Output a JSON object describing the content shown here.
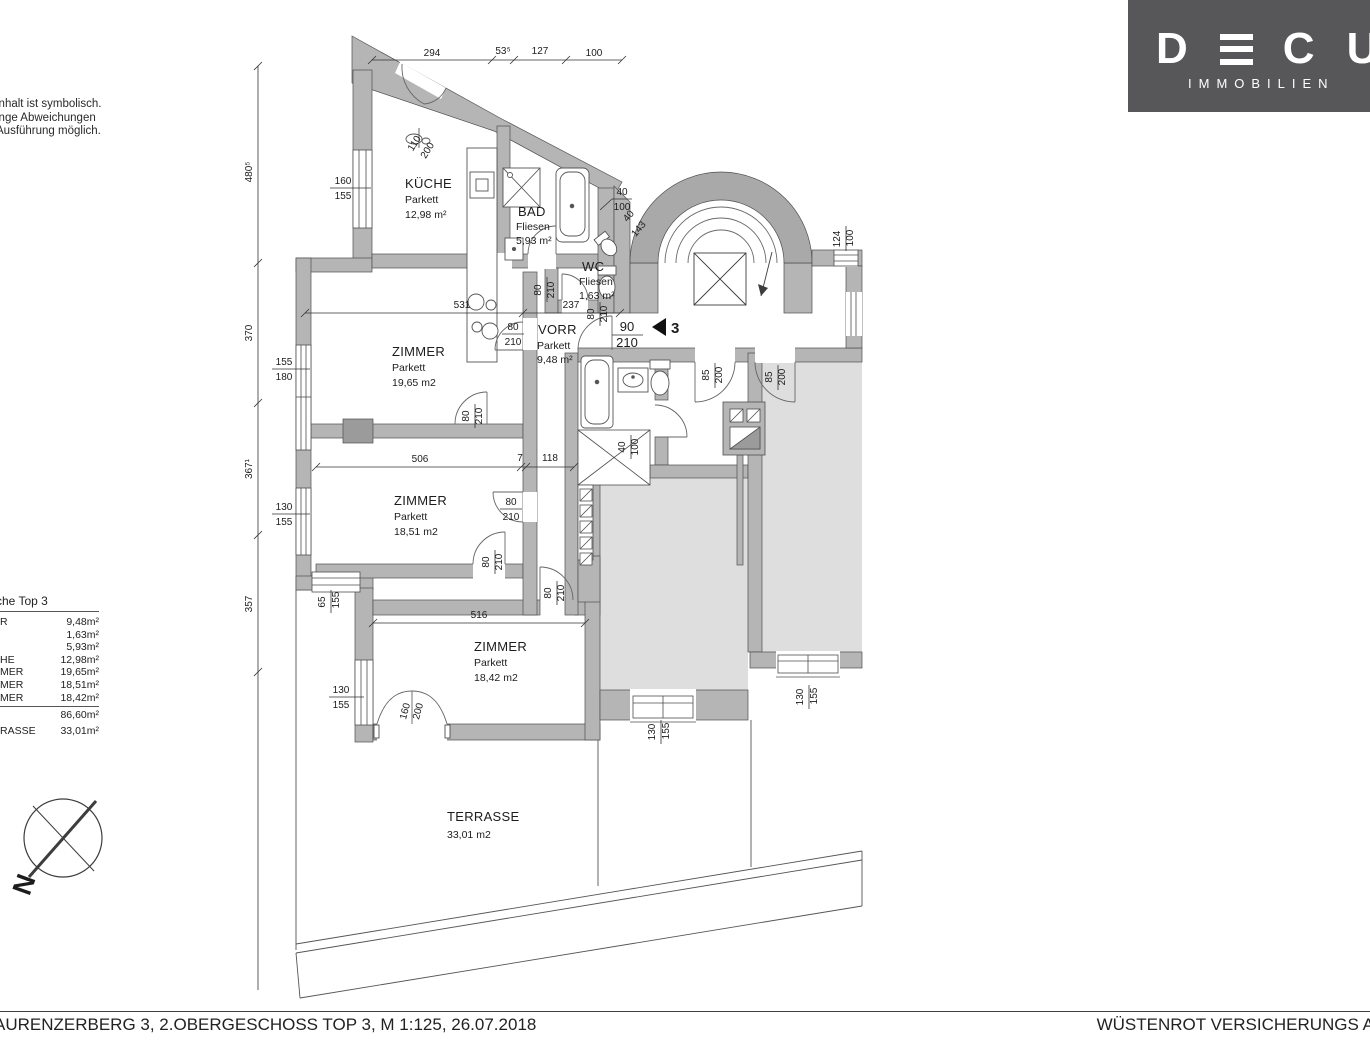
{
  "logo": {
    "letter_d": "D",
    "letter_c": "C",
    "letter_u": "U",
    "subtitle": "IMMOBILIEN"
  },
  "disclaimer": {
    "line1": "inhalt ist symbolisch.",
    "line2": "inge Abweichungen",
    "line3": "Ausführung möglich."
  },
  "area_table": {
    "title": "che Top 3",
    "rows": [
      {
        "label": "R",
        "value": "9,48m²"
      },
      {
        "label": "",
        "value": "1,63m²"
      },
      {
        "label": "",
        "value": "5,93m²"
      },
      {
        "label": "HE",
        "value": "12,98m²"
      },
      {
        "label": "MER",
        "value": "19,65m²"
      },
      {
        "label": "MER",
        "value": "18,51m²"
      },
      {
        "label": "MER",
        "value": "18,42m²"
      }
    ],
    "total": "86,60m²",
    "terrace_label": "RASSE",
    "terrace_value": "33,01m²"
  },
  "compass": {
    "north": "N"
  },
  "footer": {
    "left": "AURENZERBERG 3, 2.OBERGESCHOSS  TOP 3, M 1:125, 26.07.2018",
    "right": "WÜSTENROT VERSICHERUNGS A"
  },
  "plan": {
    "unit_marker": "3",
    "rooms": {
      "kueche": {
        "name": "KÜCHE",
        "floor": "Parkett",
        "area": "12,98 m²"
      },
      "bad": {
        "name": "BAD",
        "floor": "Fliesen",
        "area": "5,93 m²"
      },
      "wc": {
        "name": "WC",
        "floor": "Fliesen",
        "area": "1,63 m²"
      },
      "vorr": {
        "name": "VORR",
        "floor": "Parkett",
        "area": "9,48 m²"
      },
      "zimmer1": {
        "name": "ZIMMER",
        "floor": "Parkett",
        "area": "19,65 m2"
      },
      "zimmer2": {
        "name": "ZIMMER",
        "floor": "Parkett",
        "area": "18,51 m2"
      },
      "zimmer3": {
        "name": "ZIMMER",
        "floor": "Parkett",
        "area": "18,42 m2"
      },
      "terrasse": {
        "name": "TERRASSE",
        "area": "33,01 m2"
      }
    },
    "dims": {
      "top": [
        "294",
        "53⁵",
        "127",
        "100"
      ],
      "left": [
        "480⁵",
        "370",
        "367¹",
        "357"
      ],
      "h": {
        "d531": "531",
        "d237": "237",
        "d506": "506",
        "d7": "7",
        "d118": "118",
        "d516": "516"
      },
      "pairs": {
        "w160": [
          "160",
          "155"
        ],
        "d110": [
          "110",
          "200"
        ],
        "w155": [
          "155",
          "180"
        ],
        "w130a": [
          "130",
          "155"
        ],
        "w65": [
          "65",
          "155"
        ],
        "w130b": [
          "130",
          "155"
        ],
        "d160": [
          "160",
          "200"
        ],
        "d80a": [
          "80",
          "210"
        ],
        "d80b": [
          "80",
          "210"
        ],
        "d80c": [
          "80",
          "210"
        ],
        "d80d": [
          "80",
          "210"
        ],
        "d80e": [
          "80",
          "210"
        ],
        "d80f": [
          "80",
          "210"
        ],
        "d80g": [
          "80",
          "210"
        ],
        "d90": [
          "90",
          "210"
        ],
        "n40a": [
          "40",
          "100"
        ],
        "n40b": [
          "40",
          "143"
        ],
        "n40c": [
          "40",
          "100"
        ],
        "w124": [
          "124",
          "100"
        ],
        "d85a": [
          "85",
          "200"
        ],
        "d85b": [
          "85",
          "200"
        ],
        "w130c": [
          "130",
          "155"
        ],
        "w130d": [
          "130",
          "155"
        ]
      }
    }
  }
}
